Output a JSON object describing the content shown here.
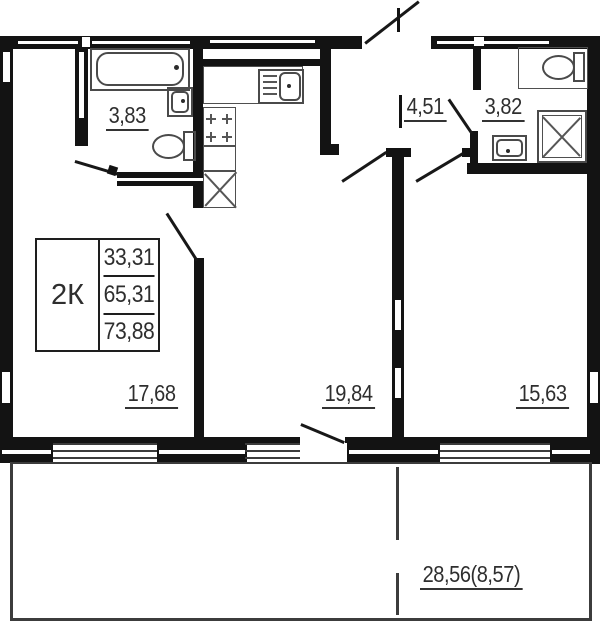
{
  "plan": {
    "legend": {
      "type": "2К",
      "rows": [
        "33,31",
        "65,31",
        "73,88"
      ]
    },
    "rooms": {
      "bathroom1": "3,83",
      "hallway": "4,51",
      "bathroom2": "3,82",
      "bedroom1": "17,68",
      "living_kitchen": "19,84",
      "bedroom2": "15,63",
      "balcony": "28,56(8,57)"
    },
    "icons": [
      "bathtub-icon",
      "sink-icon",
      "toilet-icon",
      "kitchen-sink-icon",
      "stove-icon",
      "fridge-icon",
      "shower-icon",
      "door-leaf",
      "window"
    ],
    "colors": {
      "wall": "#131313",
      "fixture_line": "#4a4a4a",
      "label_text": "#2e2e2e",
      "background": "#ffffff"
    }
  }
}
